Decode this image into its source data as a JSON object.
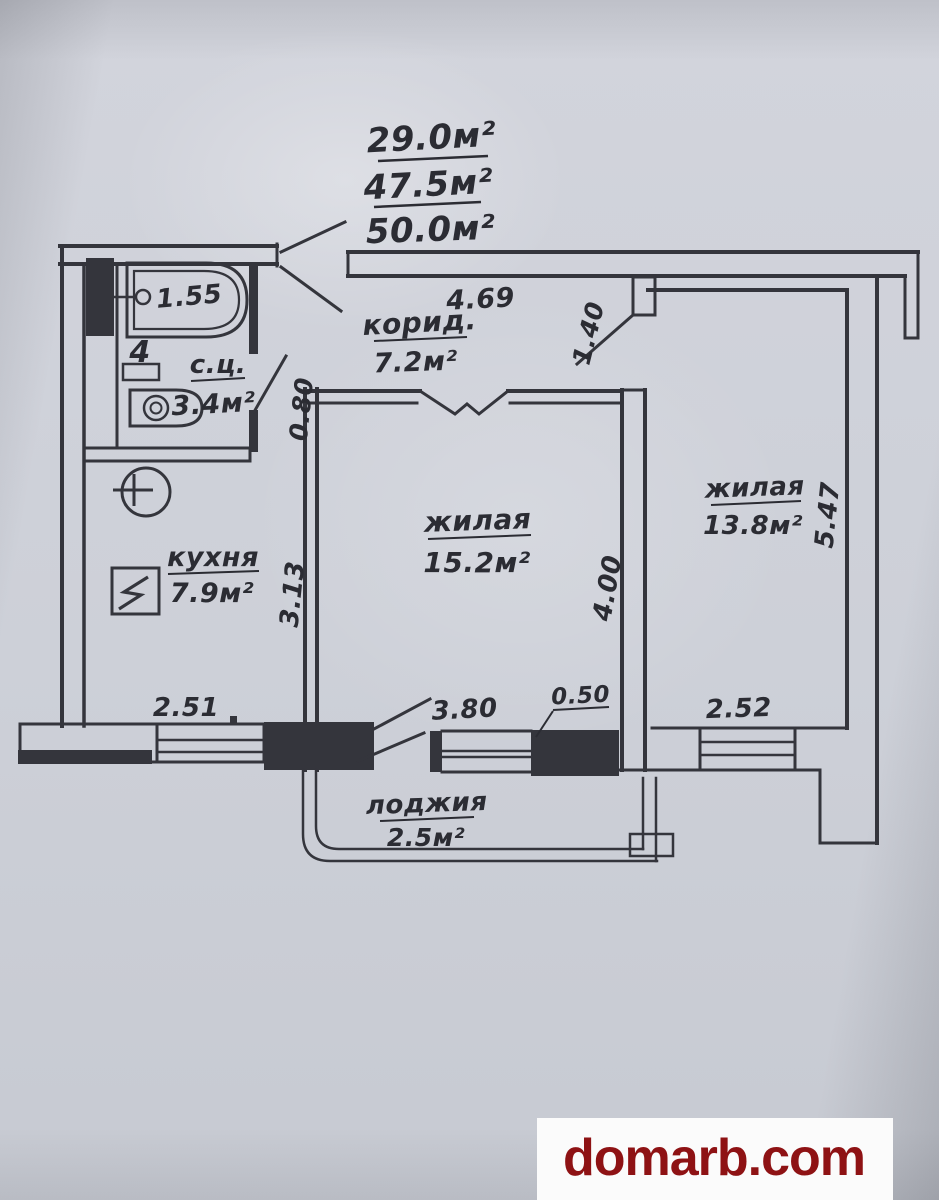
{
  "areas": {
    "living": "29.0м²",
    "usable": "47.5м²",
    "total": "50.0м²"
  },
  "rooms": {
    "corridor": {
      "name": "корид.",
      "area": "7.2м²"
    },
    "bathroom": {
      "name": "с.ц.",
      "area": "3.4м²"
    },
    "kitchen": {
      "name": "кухня",
      "area": "7.9м²"
    },
    "living1": {
      "name": "жилая",
      "area": "15.2м²"
    },
    "living2": {
      "name": "жилая",
      "area": "13.8м²"
    },
    "loggia": {
      "name": "лоджия",
      "area": "2.5м²"
    }
  },
  "dimensions": {
    "bath_width": "1.55",
    "bath_door_width": "0.80",
    "corridor_length": "4.69",
    "living2_door": "1.40",
    "kitchen_width": "2.51",
    "kitchen_depth": "3.13",
    "living1_depth": "4.00",
    "living1_window": "3.80",
    "pier_width": "0.50",
    "living2_window": "2.52",
    "living2_depth": "5.47"
  },
  "fixtures": {
    "basin_mark": "4"
  },
  "watermark": {
    "text": "domarb.com"
  },
  "colors": {
    "paper": "#cfd2da",
    "line": "#34353c",
    "text": "#2b2c33",
    "watermark_bg": "#fbfbfb",
    "watermark_text": "#8e1214"
  }
}
